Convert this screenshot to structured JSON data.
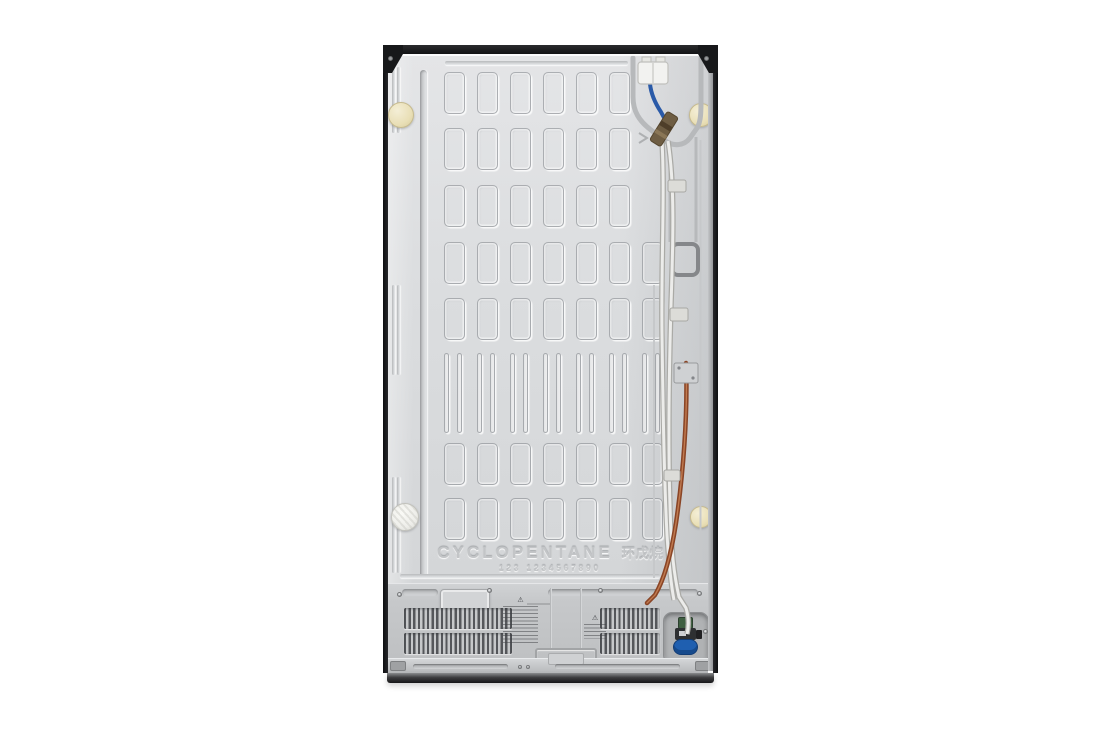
{
  "product": {
    "embossed": {
      "insulation_text": "CYCLOPENTANE",
      "insulation_text_cjk": "环戊烷",
      "embossed_digits": "123 1234567890"
    },
    "warning_symbol": "⚠"
  },
  "colors": {
    "background": "#ffffff",
    "panel": "#dbdddf",
    "edge-black": "#17181a",
    "cap-cream": "#e9dfb6",
    "cap-white": "#eeeeea",
    "wire-blue": "#2a5aa8",
    "tube-copper": "#8a4526",
    "tube-copper-light": "#c07a50",
    "tube-white": "#ececea",
    "connector-white": "#f2f2f0",
    "brass-fitting": "#6e5d43",
    "valve-blue": "#1f5fb0",
    "valve-green": "#3f5f41",
    "vent-slat": "#55575b",
    "base-dark": "#171719",
    "groove": "#b7b9bb"
  },
  "pattern": {
    "slot": {
      "x0": 61,
      "pitch": 33,
      "w": 21,
      "h": 42
    },
    "wide_rows": [
      {
        "y": 27,
        "cols": 6
      },
      {
        "y": 83,
        "cols": 6
      },
      {
        "y": 140,
        "cols": 6
      },
      {
        "y": 197,
        "cols": 7
      },
      {
        "y": 253,
        "cols": 7
      },
      {
        "y": 398,
        "cols": 7
      },
      {
        "y": 453,
        "cols": 7
      }
    ],
    "narrow_row": {
      "y": 308,
      "h": 80,
      "groups": 7,
      "slat_w": 5,
      "gap": 13
    }
  }
}
